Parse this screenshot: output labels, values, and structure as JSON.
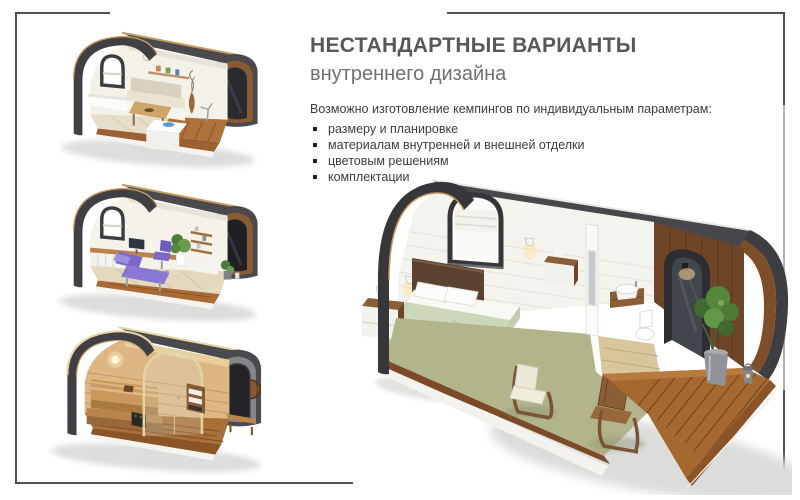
{
  "slide": {
    "title": "НЕСТАНДАРТНЫЕ ВАРИАНТЫ",
    "subtitle": "внутреннего дизайна",
    "intro": "Возможно изготовление кемпингов по индивидуальным параметрам:",
    "bullets": [
      "размеру и планировке",
      "материалам внутренней и внешней отделки",
      "цветовым решениям",
      "комплектации"
    ]
  },
  "illustrations": [
    {
      "name": "dining-pod-render"
    },
    {
      "name": "treatment-room-pod-render"
    },
    {
      "name": "sauna-pod-render"
    },
    {
      "name": "bedroom-pod-render"
    }
  ],
  "colors": {
    "border": "#51504a",
    "title": "#57585a",
    "subtitle": "#6f7073",
    "body_text": "#3c3c3e",
    "roof_dark": "#46464a",
    "wood": "#b5793f",
    "sage_floor": "#b2b48a",
    "purple_furniture": "#7b68c8"
  }
}
